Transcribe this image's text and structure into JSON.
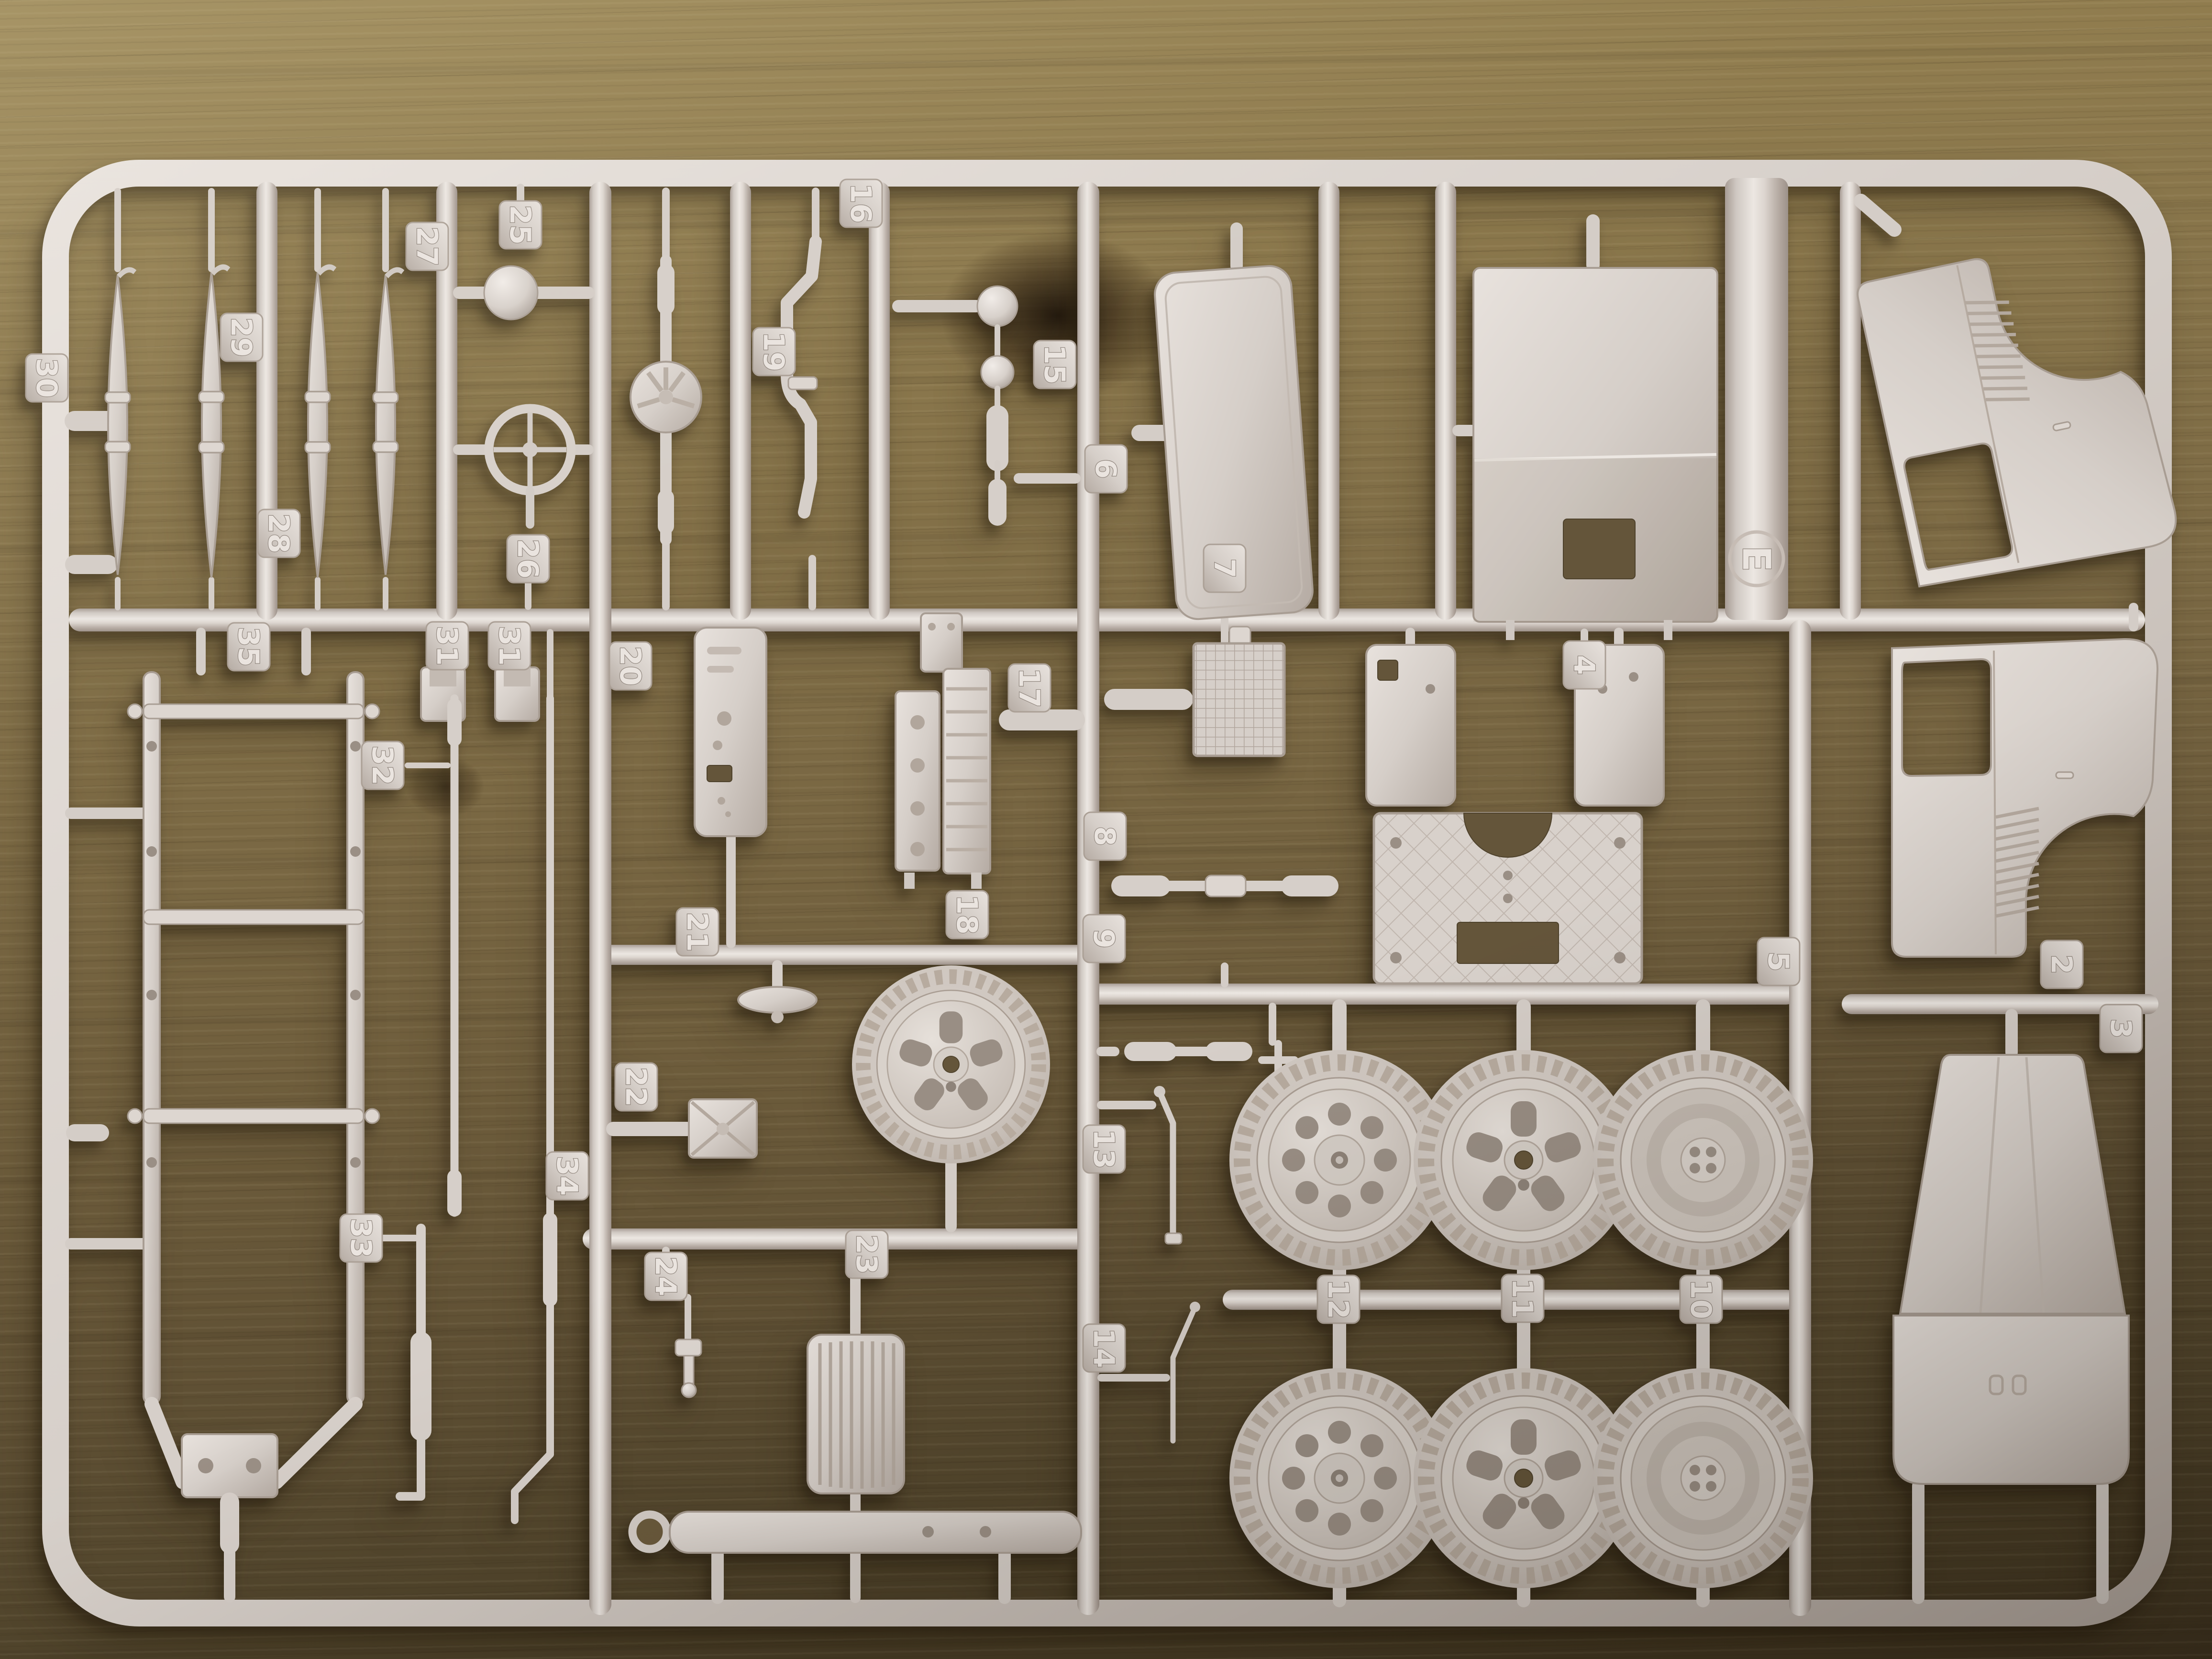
{
  "scene": {
    "description": "Light beige injection-moulded model kit sprue (runner frame E) full of numbered truck parts, photographed lying on an oak wood table",
    "sprue_frame_letter": "E",
    "colors": {
      "plastic": "#d6cfc9",
      "plastic_highlight": "#ece7e2",
      "plastic_shadow": "#a2978f",
      "wood_light": "#9d8957",
      "wood_mid": "#7b6944",
      "wood_dark": "#453a24"
    }
  },
  "parts": {
    "leaf_spring_30": {
      "number": "30",
      "label": "leaf spring"
    },
    "leaf_spring_29": {
      "number": "29",
      "label": "leaf spring"
    },
    "leaf_spring_28": {
      "number": "28",
      "label": "leaf spring"
    },
    "leaf_spring_27": {
      "number": "27",
      "label": "leaf spring"
    },
    "headlamp_25": {
      "number": "25",
      "label": "headlamp shell"
    },
    "steering_wheel_26": {
      "number": "26",
      "label": "steering wheel"
    },
    "rear_axle_19": {
      "number": "19",
      "label": "rear axle with differential"
    },
    "front_axle_16": {
      "number": "16",
      "label": "front axle beam"
    },
    "fittings_15": {
      "number": "15",
      "label": "small lamp fittings"
    },
    "windscreen_panel_6": {
      "number": "6",
      "label": "windscreen panel"
    },
    "cab_back_panel_4": {
      "number": "4",
      "label": "cab back panel with window hole"
    },
    "chassis_frame_35": {
      "number": "35",
      "label": "ladder chassis frame"
    },
    "engine_mount_31a": {
      "number": "31",
      "label": "engine mount bracket"
    },
    "engine_mount_31b": {
      "number": "31",
      "label": "engine mount bracket"
    },
    "drag_link_32": {
      "number": "32",
      "label": "steering drag link rod"
    },
    "exhaust_pipe_33": {
      "number": "33",
      "label": "exhaust pipe with silencer"
    },
    "tie_rod_34": {
      "number": "34",
      "label": "long tie rod with elbow"
    },
    "dashboard_20": {
      "number": "20",
      "label": "dashboard panel"
    },
    "engine_17": {
      "number": "17",
      "label": "engine block"
    },
    "air_filter_21": {
      "number": "21",
      "label": "air filter"
    },
    "battery_22": {
      "number": "22",
      "label": "battery box"
    },
    "radiator_7": {
      "number": "7",
      "label": "radiator core"
    },
    "track_rod_8": {
      "number": "8",
      "label": "track rod"
    },
    "steering_link_9": {
      "number": "9",
      "label": "steering link and valve"
    },
    "handbrake_lever_13": {
      "number": "13",
      "label": "handbrake lever"
    },
    "gear_lever_14": {
      "number": "14",
      "label": "gear lever"
    },
    "bracket_24": {
      "number": "24",
      "label": "small mounting bracket"
    },
    "radiator_grille_23": {
      "number": "23",
      "label": "radiator grille"
    },
    "spare_wheel_18": {
      "number": "18",
      "label": "spare wheel"
    },
    "cab_floor_5": {
      "number": "5",
      "label": "cab floor with wheel arches"
    },
    "cab_side_left_2": {
      "number": "2",
      "label": "cab side panel left"
    },
    "cab_roof_3": {
      "number": "3",
      "label": "cab roof and front panel"
    },
    "wheel_pair_12": {
      "number": "12",
      "label": "road wheels, spoked hub"
    },
    "wheel_pair_11": {
      "number": "11",
      "label": "road wheels, slotted hub"
    },
    "wheel_pair_10": {
      "number": "10",
      "label": "road wheels, inner face"
    },
    "cab_side_right": {
      "label": "cab side panel right"
    }
  }
}
